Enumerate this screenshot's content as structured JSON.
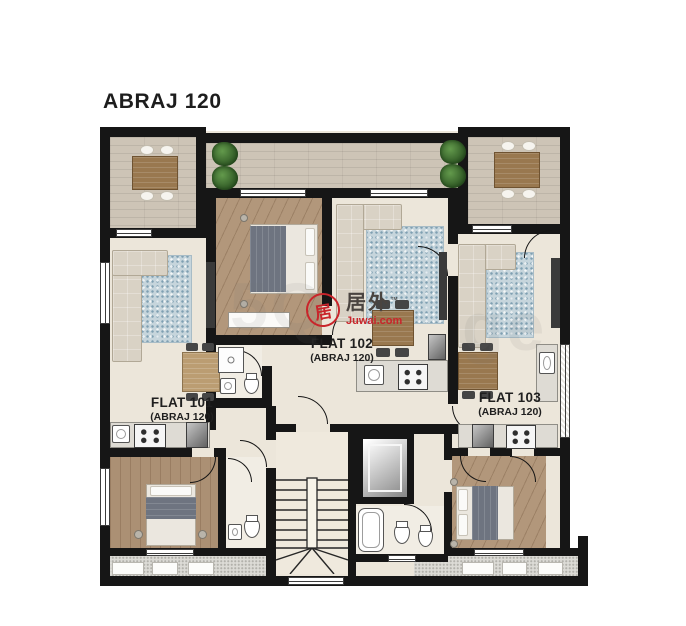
{
  "title": "ABRAJ 120",
  "flats": [
    {
      "name": "FLAT 101",
      "sub": "(ABRAJ 120)"
    },
    {
      "name": "FLAT 102",
      "sub": "(ABRAJ 120)"
    },
    {
      "name": "FLAT 103",
      "sub": "(ABRAJ 120)"
    }
  ],
  "watermark": {
    "seal_char": "居",
    "brand": "居外",
    "tm": "™",
    "domain": "Juwai.com"
  },
  "ghost": {
    "left": "5Q",
    "right": "ge"
  },
  "colors": {
    "accent_red": "#c9252b",
    "wall": "#161616",
    "wood_terrace": "#cdc4b6",
    "wood_bedroom": "#b2977b",
    "tile": "#ece6da",
    "rug_blue": "#c6d5dc"
  }
}
